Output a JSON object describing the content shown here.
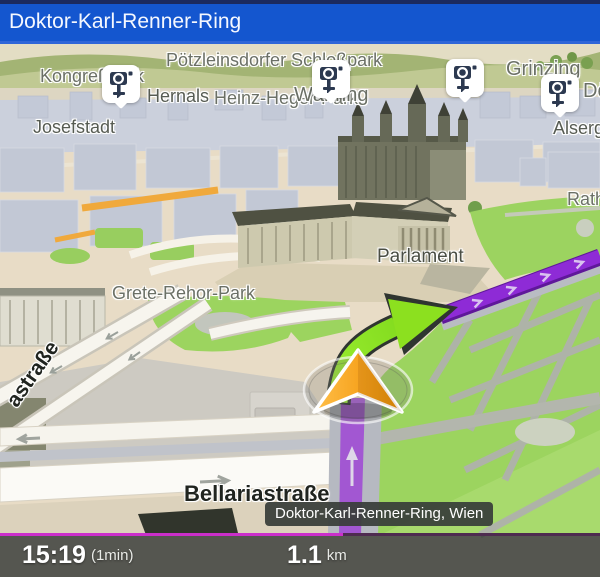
{
  "header": {
    "title": "Doktor-Karl-Renner-Ring"
  },
  "map": {
    "area_labels": [
      {
        "id": "kongresspark",
        "text": "Kongreßpark"
      },
      {
        "id": "hernals",
        "text": "Hernals"
      },
      {
        "id": "poetzleinsdorfer-schlosspark",
        "text": "Pötzleinsdorfer Schloßpark"
      },
      {
        "id": "heinz-heger-park",
        "text": "Heinz-Heger-Park"
      },
      {
        "id": "waehring",
        "text": "Währing"
      },
      {
        "id": "grinzing",
        "text": "Grinzing"
      },
      {
        "id": "doebling-partial",
        "text": "Dö"
      },
      {
        "id": "josefstadt",
        "text": "Josefstadt"
      },
      {
        "id": "alsergrund-partial",
        "text": "Alsergr"
      },
      {
        "id": "rathauspark-partial",
        "text": "Rath"
      },
      {
        "id": "parlament",
        "text": "Parlament"
      },
      {
        "id": "grete-rehor-park",
        "text": "Grete-Rehor-Park"
      }
    ],
    "street_labels": [
      {
        "id": "bellariastrasse",
        "text": "Bellariastraße"
      },
      {
        "id": "strasse-partial",
        "text": "astraße"
      }
    ],
    "location_tooltip": "Doktor-Karl-Renner-Ring, Wien",
    "speed_cameras": {
      "icon": "speed-camera-icon",
      "count": 4
    },
    "colors": {
      "route_purple": "#8e2bd6",
      "maneuver_arrow_green": "#86e01f",
      "position_arrow_orange": "#f6a21d",
      "park_green": "#9cd45f",
      "header_blue": "#1456cf",
      "progress_magenta": "#cb2fcb"
    }
  },
  "bottom_bar": {
    "arrival_time": "15:19",
    "duration": "(1min)",
    "distance_value": "1.1",
    "distance_unit": "km"
  }
}
